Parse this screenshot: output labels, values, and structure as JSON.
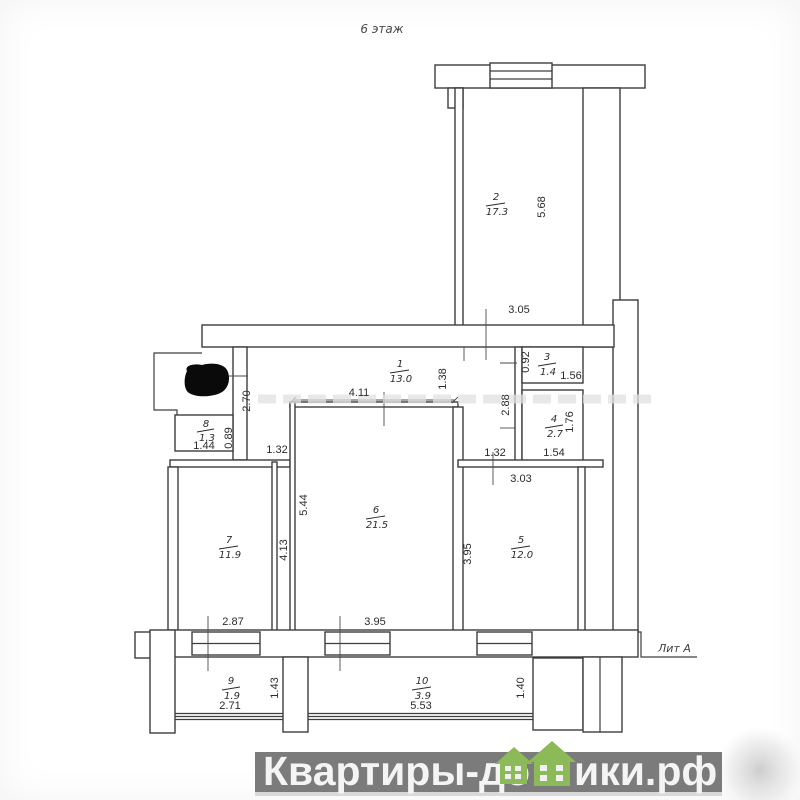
{
  "page": {
    "floor_title": "6 этаж",
    "liter_label": "Лит А"
  },
  "rooms": [
    {
      "number": "1",
      "area": "13.0"
    },
    {
      "number": "2",
      "area": "17.3"
    },
    {
      "number": "3",
      "area": "1.4"
    },
    {
      "number": "4",
      "area": "2.7"
    },
    {
      "number": "5",
      "area": "12.0"
    },
    {
      "number": "6",
      "area": "21.5"
    },
    {
      "number": "7",
      "area": "11.9"
    },
    {
      "number": "8",
      "area": "1.3"
    },
    {
      "number": "9",
      "area": "1.9"
    },
    {
      "number": "10",
      "area": "3.9"
    }
  ],
  "dimensions": [
    "5.68",
    "3.05",
    "0.92",
    "1.56",
    "1.38",
    "2.88",
    "1.76",
    "1.54",
    "1.32",
    "3.03",
    "4.11",
    "2.70",
    "0.89",
    "1.44",
    "1.32",
    "5.44",
    "4.13",
    "3.95",
    "2.87",
    "3.95",
    "2.71",
    "1.43",
    "5.53",
    "1.40"
  ],
  "watermark": {
    "prefix": "Квартиры-до",
    "suffix": "ики.рф",
    "banner_color": "#7b7b7b",
    "text_color": "#f4f4f4",
    "house_color": "#8cba58"
  }
}
